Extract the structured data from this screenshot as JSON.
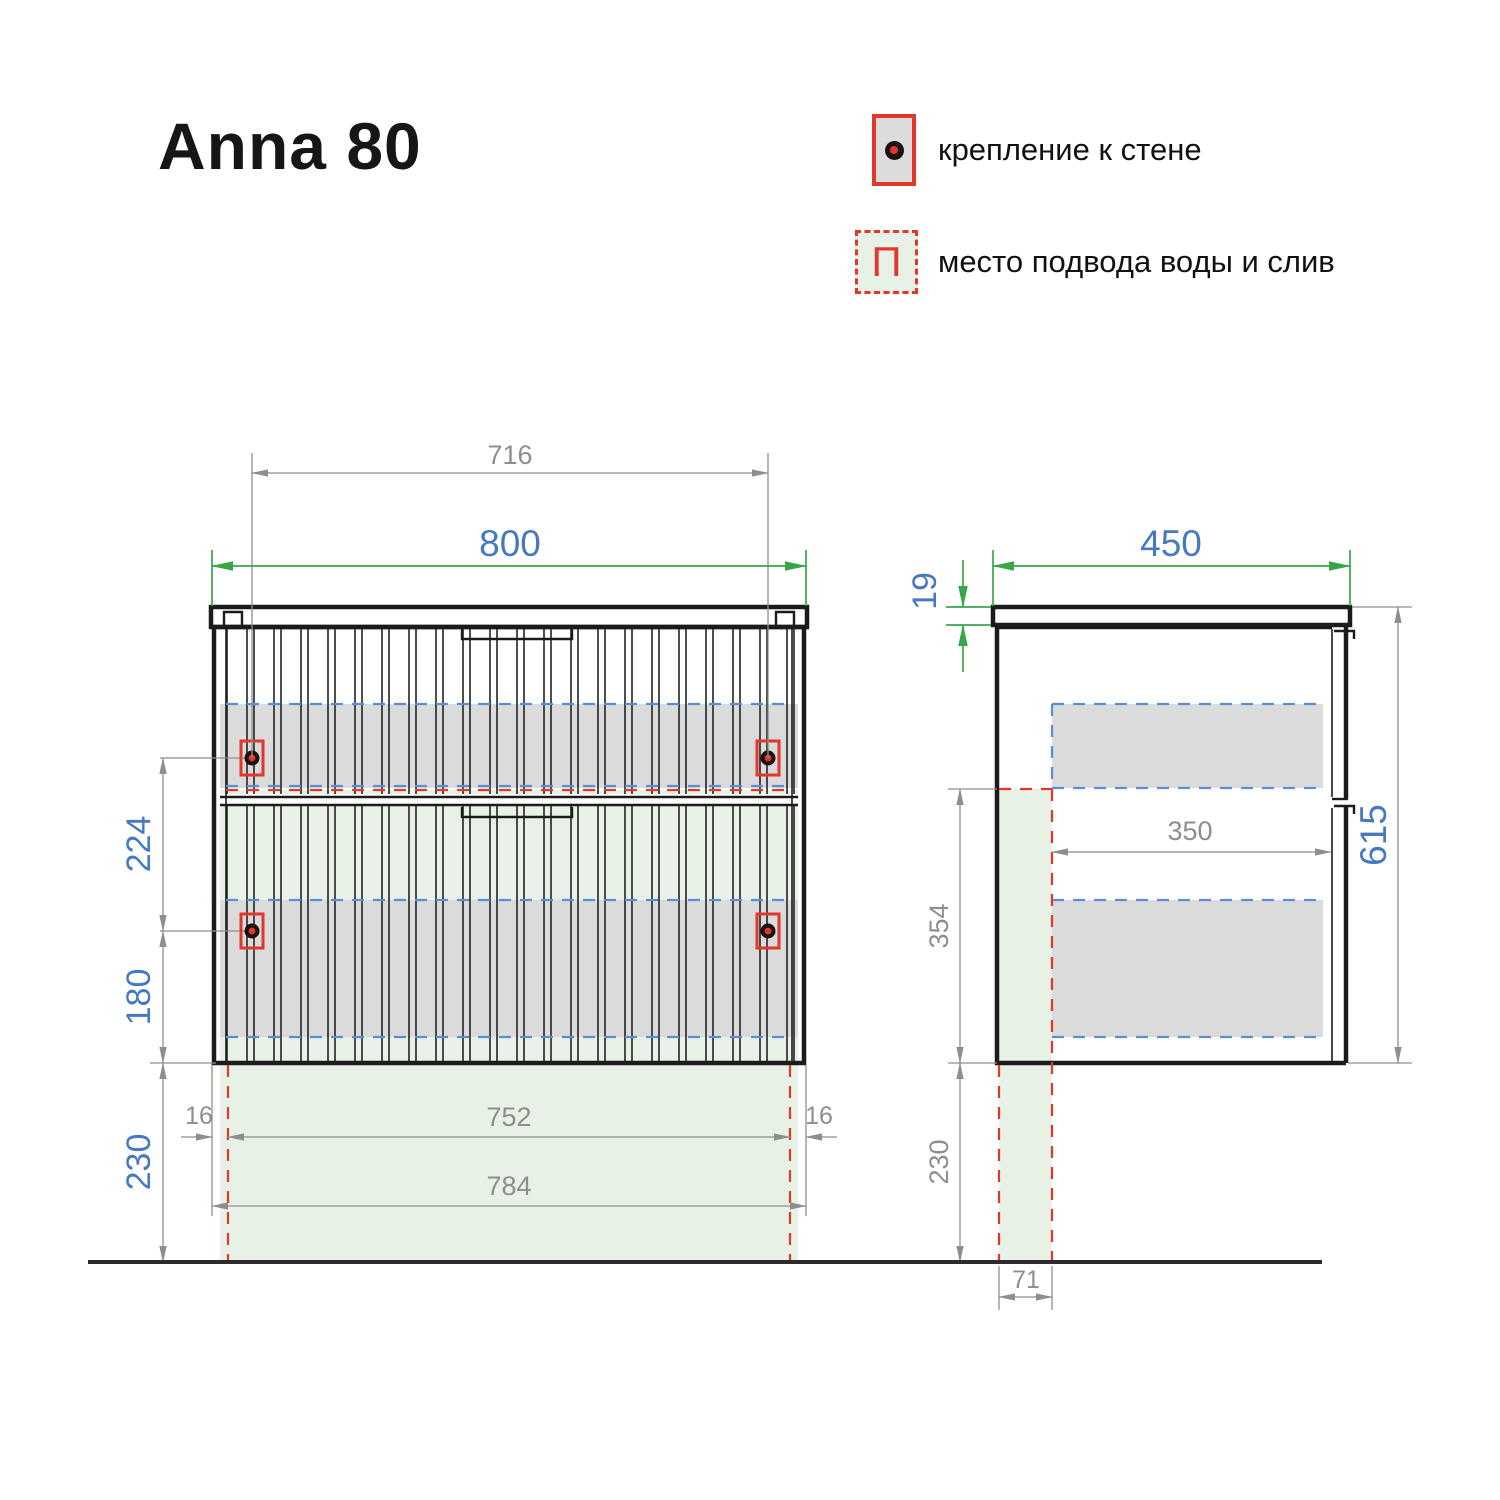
{
  "title": "Anna 80",
  "legend": {
    "wall_mount": {
      "label": "крепление к стене"
    },
    "water_supply": {
      "label": "место подвода воды и слив",
      "symbol": "П"
    }
  },
  "front_view": {
    "mount_spacing": "716",
    "total_width": "800",
    "bracket_vertical_spacing": "224",
    "bracket_to_bottom": "180",
    "floor_clearance": "230",
    "inset_left": "16",
    "inset_right": "16",
    "clear_width": "752",
    "back_panel_width": "784"
  },
  "side_view": {
    "total_depth": "450",
    "countertop_thickness": "19",
    "body_height": "615",
    "clear_depth": "350",
    "supply_zone_height": "354",
    "floor_clearance": "230",
    "supply_zone_depth": "71"
  },
  "colors": {
    "accent_red": "#e2382c",
    "dim_green": "#3aa44a",
    "dim_blue": "#4579c0",
    "dim_gray": "#8e8e8e",
    "line_dark": "#1b1b1b",
    "band_gray": "#dbdbdb",
    "zone_green": "#e7f1e6",
    "dash_blue": "#5b8ed5"
  }
}
